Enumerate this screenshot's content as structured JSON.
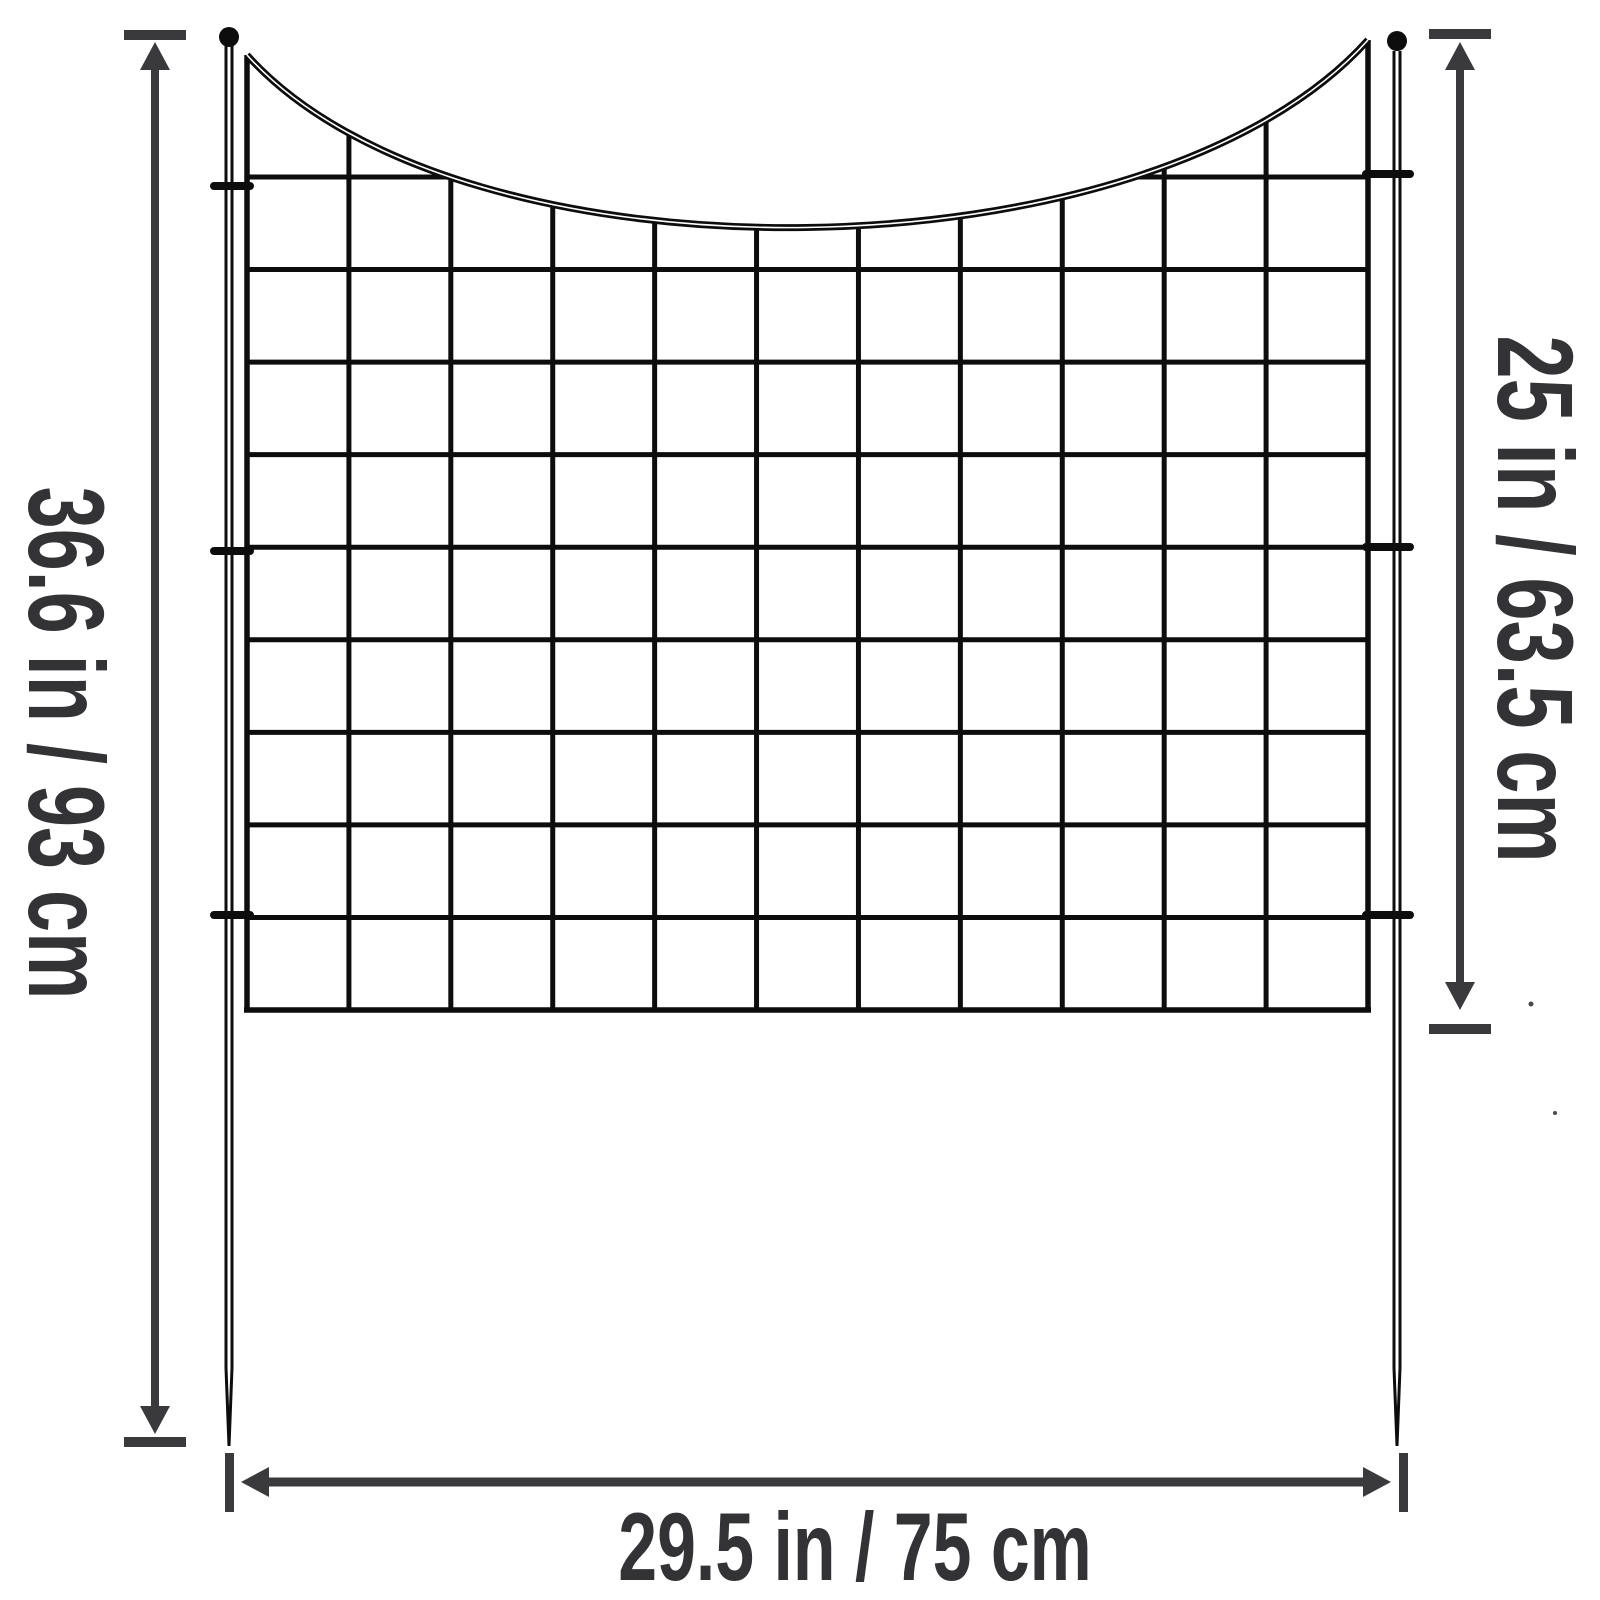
{
  "colors": {
    "background": "#ffffff",
    "fence": "#0d0d0d",
    "annotation": "#3a3a3c",
    "label_text": "#333336",
    "speck": "#4a4a4c"
  },
  "fence": {
    "type": "wire-grid-garden-fence-panel",
    "grid_columns": 11,
    "grid_rows": 9,
    "top_edge": "concave-dip-curve",
    "stake_finial": "ball",
    "stake_tip": "pointed"
  },
  "dimension_annotations": [
    {
      "id": "total-height",
      "text": "36.6 in / 93 cm",
      "side": "left",
      "orientation": "vertical"
    },
    {
      "id": "panel-height",
      "text": "25 in / 63.5 cm",
      "side": "right",
      "orientation": "vertical"
    },
    {
      "id": "panel-width",
      "text": "29.5 in / 75 cm",
      "side": "bottom",
      "orientation": "horizontal"
    }
  ]
}
